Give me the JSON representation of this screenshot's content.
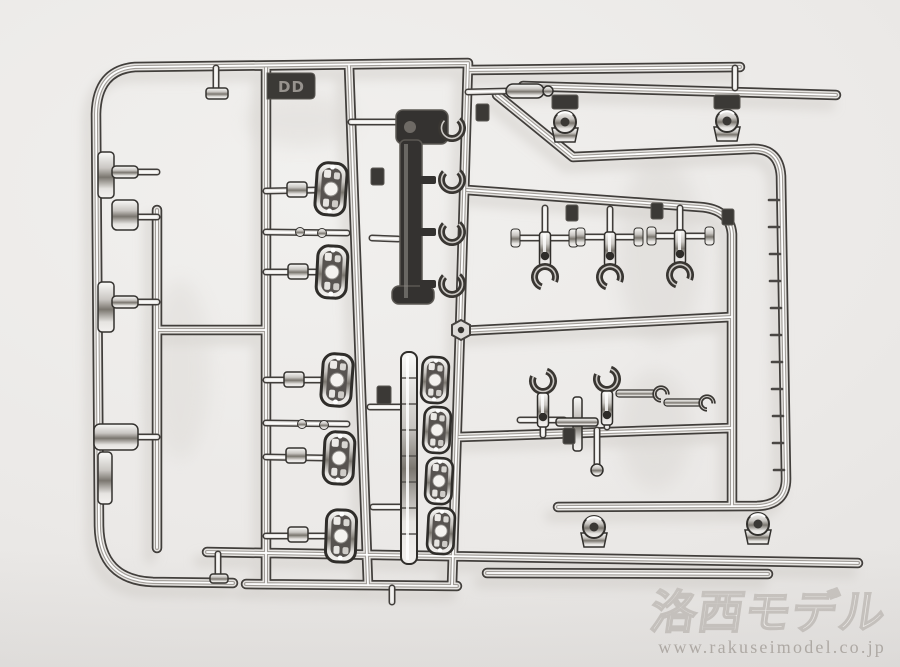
{
  "photo": {
    "background_color": "#ebe9e7",
    "subject": "chrome plated model kit parts sprue",
    "sprue": {
      "tag_label": "DD"
    }
  },
  "watermark": {
    "brand": "洛西モデル",
    "url": "www.rakuseimodel.co.jp"
  },
  "css_vars": {
    "bg": "#ebe9e7",
    "chrome-dark": "#413e3b",
    "chrome-hi": "#ffffff",
    "shadow": "#cfccc8",
    "wm-stroke": "#c8c4c0",
    "wm-url": "#b2ada8"
  }
}
